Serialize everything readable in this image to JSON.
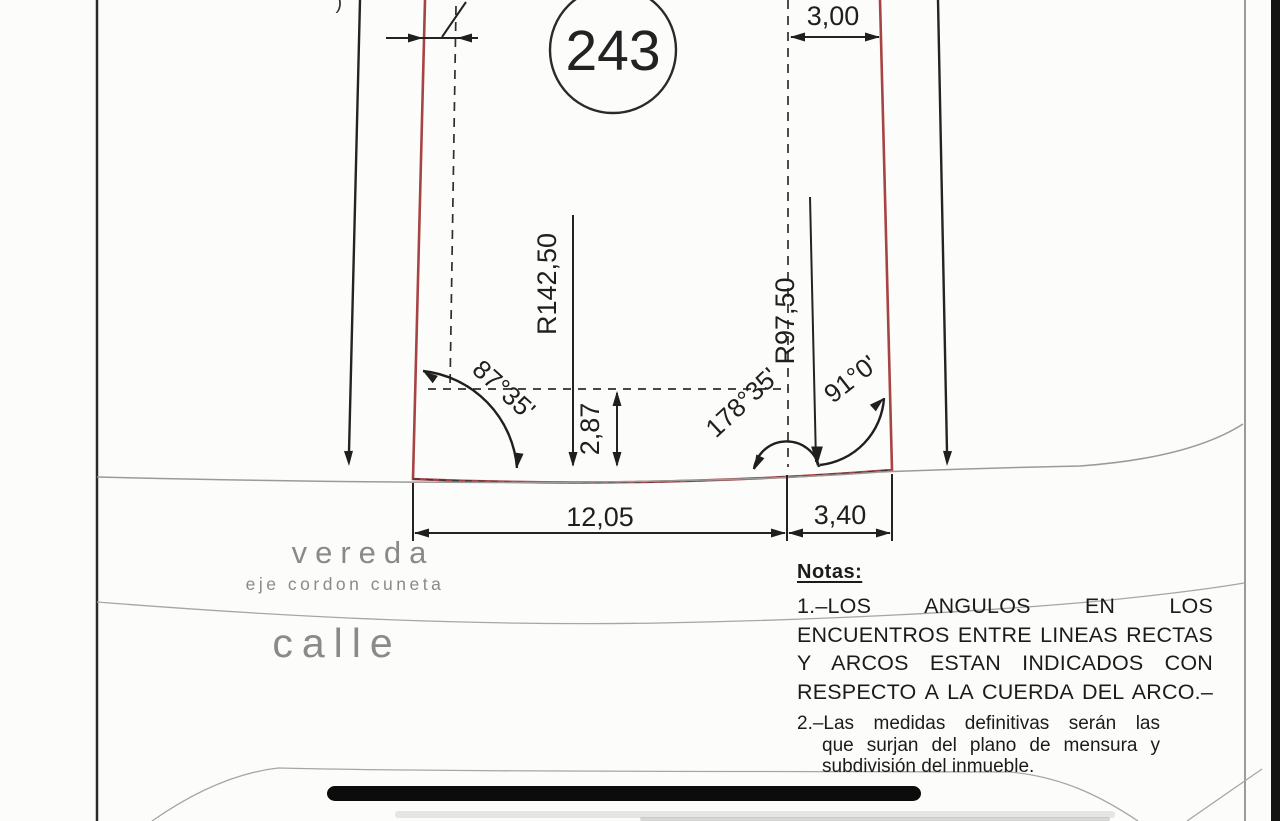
{
  "drawing": {
    "parcel_number": "243",
    "top_partial_mark": "’)",
    "dimensions": {
      "top_left_gap": "",
      "top_right": "3,00",
      "bottom_main": "12,05",
      "bottom_right": "3,40",
      "sagitta": "2,87",
      "radius_left": "R142,50",
      "radius_right": "R97,50"
    },
    "angles": {
      "left": "87°35'",
      "middle": "178°35'",
      "right": "91°0'"
    },
    "street_labels": {
      "sidewalk": "vereda",
      "curb_axis": "eje cordon cuneta",
      "street": "calle"
    },
    "colors": {
      "parcel_outline": "#a64343",
      "drafting_lines": "#232323",
      "street_lines": "#9a9a9a",
      "street_label_gray": "#8a8a8a",
      "redaction_bar": "#0c0c0c"
    }
  },
  "notes": {
    "title": "Notas:",
    "note1_lines": [
      "1.–LOS ANGULOS EN LOS",
      "ENCUENTROS ENTRE LINEAS RECTAS",
      "Y ARCOS ESTAN INDICADOS CON",
      "RESPECTO A LA CUERDA DEL ARCO.–"
    ],
    "note2_lines": [
      "2.–Las medidas definitivas serán las",
      "que surjan del plano de mensura y",
      "subdivisión del inmueble."
    ]
  }
}
